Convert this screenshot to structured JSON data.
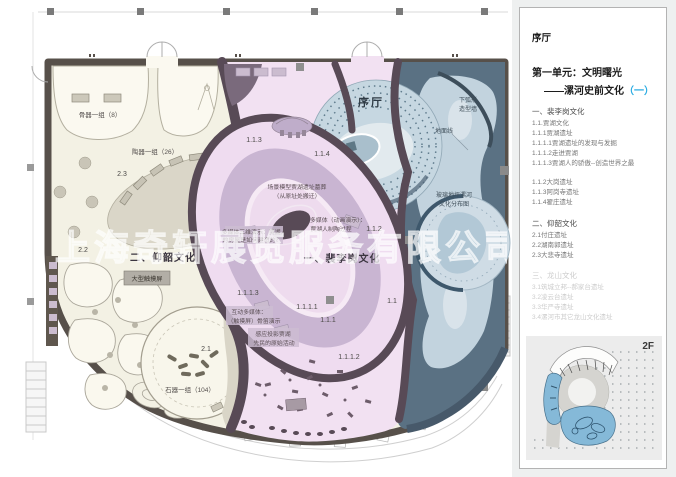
{
  "watermark": {
    "text": "上海奇轩展览服务有限公司"
  },
  "colors": {
    "accent": "#29abe2",
    "wall": "#57504a",
    "partition": "#584a56",
    "pink_zone": "#f2e1f2",
    "cream_zone": "#f3f1e4",
    "blue_zone": "#c2d3de",
    "slate": "#5a7183",
    "lavender": "#c9b5d2"
  },
  "plan": {
    "labels": [
      {
        "text": "序厅"
      },
      {
        "text": "骨器一组（8）"
      },
      {
        "text": "陶器一组（26）"
      },
      {
        "text": "2.3"
      },
      {
        "text": "2.2"
      },
      {
        "text": "二、仰韶文化"
      },
      {
        "text": "大型触摸屏"
      },
      {
        "text": "2.1"
      },
      {
        "text": "石器一组（104）"
      },
      {
        "text": "1.1.3"
      },
      {
        "text": "1.1.4"
      },
      {
        "text": "场景模型贾湖遗址墓葬"
      },
      {
        "text": "（从原址处搬迁）"
      },
      {
        "text": "多媒体（动画演示）："
      },
      {
        "text": "贾湖人制陶过程"
      },
      {
        "text": "1.1.2"
      },
      {
        "text": "多媒体三维演示：贾湖人"
      },
      {
        "text": "的房屋是如何建造的？"
      },
      {
        "text": "一、裴李岗文化"
      },
      {
        "text": "1.1"
      },
      {
        "text": "1.1.1.1"
      },
      {
        "text": "1.1.1"
      },
      {
        "text": "1.1.1.3"
      },
      {
        "text": "互动多媒体："
      },
      {
        "text": "（触摸屏）骨笛演示"
      },
      {
        "text": "感应投影贾湖"
      },
      {
        "text": "先民的原始活动"
      },
      {
        "text": "1.1.1.2"
      },
      {
        "text": "下弧形"
      },
      {
        "text": "造型墙"
      },
      {
        "text": "地面线"
      },
      {
        "text": "玻璃地坪漯河"
      },
      {
        "text": "文化分布图"
      }
    ]
  },
  "right_panel": {
    "hall_title": "序厅",
    "unit_title": "第一单元：文明曙光",
    "unit_subtitle_dash": "——漯河史前文化",
    "unit_subtitle_paren": "（一）",
    "floor_label": "2F",
    "groups": [
      {
        "heading": "一、裴李岗文化",
        "items": [
          "1.1.贾湖文化",
          "1.1.1贾湖遗址",
          "1.1.1.1贾湖遗址的发现与发掘",
          "1.1.1.2走进贾湖",
          "1.1.1.3贾湖人的骄傲--创造世界之最"
        ]
      },
      {
        "items": [
          "1.1.2大岗遗址",
          "1.1.3阿岗寺遗址",
          "1.1.4翟庄遗址"
        ]
      },
      {
        "heading": "二、仰韶文化",
        "items": [
          "2.1付庄遗址",
          "2.2湖南郭遗址",
          "2.3大悲寺遗址"
        ]
      },
      {
        "heading": "三、龙山文化",
        "items": [
          "3.1筑城立邦--郝家台遗址",
          "3.2凌云台遗址",
          "3.3华严寺遗址",
          "3.4漯河市其它龙山文化遗址"
        ]
      }
    ]
  }
}
